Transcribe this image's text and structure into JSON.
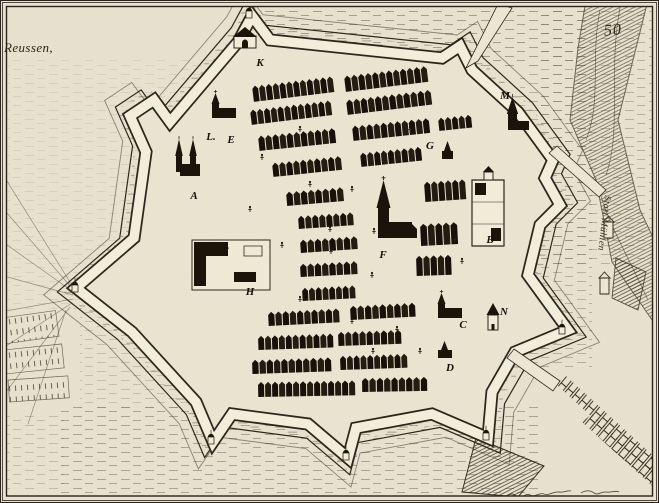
{
  "page": {
    "number": "50"
  },
  "map": {
    "region_label": "Reussen,",
    "road_label": "Statt Mühlen",
    "legend_markers": [
      {
        "letter": "K",
        "x": 260,
        "y": 63
      },
      {
        "letter": "L.",
        "x": 211,
        "y": 137
      },
      {
        "letter": "E",
        "x": 231,
        "y": 140
      },
      {
        "letter": "A",
        "x": 194,
        "y": 196
      },
      {
        "letter": "I.",
        "x": 226,
        "y": 246
      },
      {
        "letter": "H",
        "x": 250,
        "y": 292
      },
      {
        "letter": "M",
        "x": 505,
        "y": 96
      },
      {
        "letter": "G",
        "x": 430,
        "y": 146
      },
      {
        "letter": "B",
        "x": 490,
        "y": 240
      },
      {
        "letter": "F",
        "x": 383,
        "y": 255
      },
      {
        "letter": "C",
        "x": 463,
        "y": 325
      },
      {
        "letter": "N",
        "x": 504,
        "y": 312
      },
      {
        "letter": "D",
        "x": 450,
        "y": 368
      }
    ]
  },
  "colors": {
    "paper": "#e8e3cf",
    "city_ground": "#eae6d1",
    "wall_band": "#f3efdc",
    "ink": "#2b251c",
    "building_dark": "#191309",
    "hatch": "#6e6758"
  },
  "scene": {
    "house_rows": [
      [
        252,
        86,
        82,
        16,
        -7
      ],
      [
        344,
        76,
        84,
        16,
        -7
      ],
      [
        250,
        110,
        82,
        15,
        -7
      ],
      [
        346,
        100,
        86,
        15,
        -7
      ],
      [
        258,
        136,
        78,
        15,
        -6
      ],
      [
        352,
        126,
        78,
        15,
        -6
      ],
      [
        438,
        118,
        34,
        13,
        -6
      ],
      [
        272,
        163,
        70,
        14,
        -6
      ],
      [
        360,
        153,
        62,
        14,
        -6
      ],
      [
        286,
        192,
        58,
        14,
        -5
      ],
      [
        298,
        216,
        56,
        13,
        -4
      ],
      [
        300,
        240,
        58,
        13,
        -4
      ],
      [
        300,
        264,
        58,
        13,
        -3
      ],
      [
        302,
        288,
        54,
        13,
        -3
      ],
      [
        424,
        182,
        42,
        20,
        -4
      ],
      [
        420,
        224,
        38,
        22,
        -3
      ],
      [
        416,
        256,
        36,
        20,
        -2
      ],
      [
        268,
        312,
        72,
        14,
        -3
      ],
      [
        350,
        306,
        66,
        14,
        -3
      ],
      [
        258,
        336,
        76,
        14,
        -2
      ],
      [
        338,
        332,
        64,
        14,
        -2
      ],
      [
        252,
        360,
        80,
        14,
        -2
      ],
      [
        340,
        356,
        68,
        14,
        -2
      ],
      [
        258,
        382,
        98,
        15,
        -1
      ],
      [
        362,
        378,
        66,
        14,
        -1
      ]
    ],
    "buildings": [
      {
        "t": "gate",
        "x": 234,
        "y": 30
      },
      {
        "t": "church",
        "x": 212,
        "y": 100
      },
      {
        "t": "twin",
        "x": 176,
        "y": 150
      },
      {
        "t": "court",
        "x": 192,
        "y": 240
      },
      {
        "t": "big",
        "x": 378,
        "y": 196
      },
      {
        "t": "chapel",
        "x": 442,
        "y": 146
      },
      {
        "t": "wallchurch",
        "x": 506,
        "y": 108
      },
      {
        "t": "palace",
        "x": 472,
        "y": 180
      },
      {
        "t": "church",
        "x": 438,
        "y": 300
      },
      {
        "t": "small",
        "x": 438,
        "y": 346
      },
      {
        "t": "tower",
        "x": 488,
        "y": 310
      },
      {
        "t": "mill",
        "x": 604,
        "y": 222
      },
      {
        "t": "mill",
        "x": 600,
        "y": 278
      },
      {
        "t": "turret",
        "x": 208,
        "y": 434
      },
      {
        "t": "turret",
        "x": 343,
        "y": 450
      },
      {
        "t": "turret",
        "x": 483,
        "y": 430
      },
      {
        "t": "turret",
        "x": 559,
        "y": 324
      },
      {
        "t": "turret",
        "x": 246,
        "y": 8
      },
      {
        "t": "turret",
        "x": 72,
        "y": 282
      }
    ],
    "figures": [
      [
        262,
        160
      ],
      [
        310,
        187
      ],
      [
        352,
        192
      ],
      [
        330,
        232
      ],
      [
        374,
        234
      ],
      [
        282,
        248
      ],
      [
        331,
        254
      ],
      [
        372,
        278
      ],
      [
        300,
        302
      ],
      [
        352,
        324
      ],
      [
        397,
        332
      ],
      [
        420,
        354
      ],
      [
        373,
        354
      ],
      [
        455,
        242
      ],
      [
        462,
        264
      ],
      [
        250,
        212
      ],
      [
        410,
        132
      ],
      [
        300,
        132
      ]
    ]
  }
}
